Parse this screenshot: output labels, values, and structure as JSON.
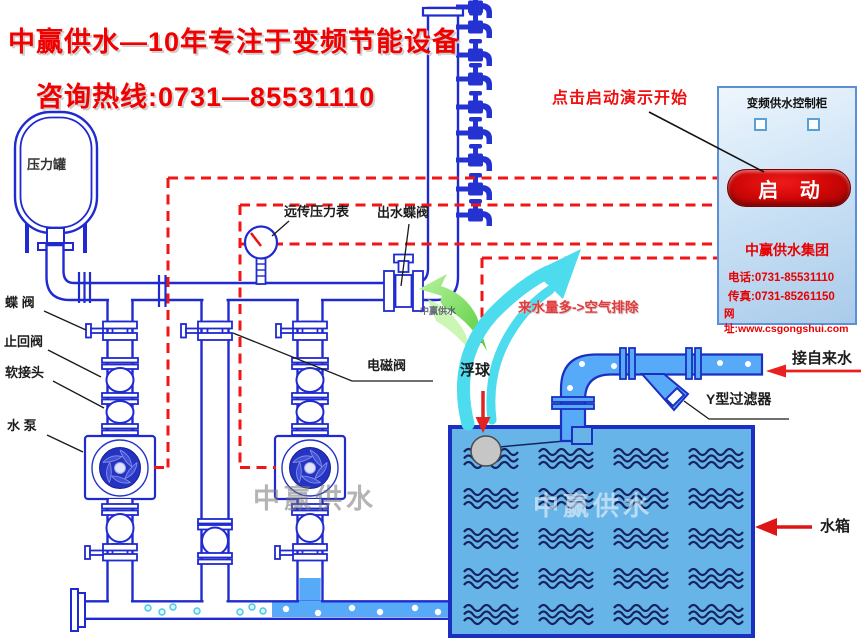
{
  "title": {
    "line1": "中赢供水—10年专注于变频节能设备",
    "hotline": "咨询热线:0731—85531110"
  },
  "demo": {
    "hint": "点击启动演示开始"
  },
  "cabinet": {
    "title": "变频供水控制柜",
    "start_label": "启 动",
    "company": "中赢供水集团",
    "phone": "电话:0731-85531110",
    "fax": "传真:0731-85261150",
    "website": "网址:www.csgongshui.com"
  },
  "labels": {
    "pressure_tank": "压力罐",
    "remote_pressure_gauge": "远传压力表",
    "outlet_butterfly_valve": "出水蝶阀",
    "butterfly_valve": "蝶 阀",
    "check_valve": "止回阀",
    "flexible_joint": "软接头",
    "water_pump": "水 泵",
    "solenoid_valve": "电磁阀",
    "float_ball": "浮球",
    "air_vent_note": "来水量多->空气排除",
    "tap_water_inlet": "接自来水",
    "y_strainer": "Y型过滤器",
    "water_tank": "水箱"
  },
  "watermarks": {
    "center": "中赢供水",
    "tank": "中赢供水",
    "riser": "中赢供水"
  },
  "colors": {
    "accent_red": "#f20000",
    "pipe_blue": "#1f2ad0",
    "pipe_water_fill": "#57aaf8",
    "tank_water_fill": "#66b4e8",
    "start_button_red": "#c00000",
    "arrow_green": "#66d94e",
    "arrow_cyan": "#4cdcee"
  }
}
